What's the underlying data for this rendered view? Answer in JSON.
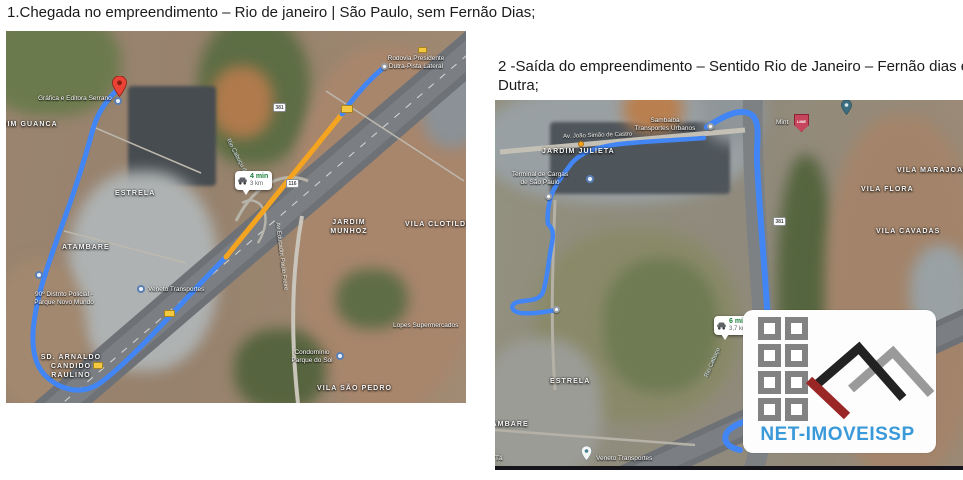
{
  "page": {
    "title1": "1.Chegada no empreendimento – Rio de janeiro | São Paulo, sem Fernão Dias;",
    "title2_line1": "2 -Saída do empreendimento – Sentido Rio de Janeiro – Fernão dias e",
    "title2_line2": "Dutra;"
  },
  "map1": {
    "eta": {
      "time": "4 min",
      "dist": "3 km"
    },
    "shields": {
      "br381": "381",
      "br116": "116"
    },
    "labels": {
      "grafica": "Gráfica e Editora Serrano",
      "guanca": "JARDIM GUANCA",
      "estrela": "ESTRELA",
      "dutra_l1": "Rodovia Presidente",
      "dutra_l2": "Dutra-Pista Lateral",
      "cabucu": "Rio Cabuçu de Cima",
      "atambare": "ATAMBARE",
      "police_l1": "90º Distrito Policial -",
      "police_l2": "Parque Novo Mundo",
      "veneto": "Veneto Transportes",
      "arnaldo_l1": "SD. ARNALDO",
      "arnaldo_l2": "CANDIDO",
      "arnaldo_l3": "RAULINO",
      "munhoz_l1": "JARDIM",
      "munhoz_l2": "MUNHOZ",
      "clotilde": "VILA CLOTILDE",
      "freire": "Av Educador Paulo Freire",
      "lopes": "Lopes Supermercados",
      "condominio_l1": "Condomínio",
      "condominio_l2": "Parque do Sol",
      "saopedro": "VILA SÃO PEDRO"
    }
  },
  "map2": {
    "eta": {
      "time": "6 min",
      "dist": "3,7 km"
    },
    "shields": {
      "br381": "381"
    },
    "labels": {
      "sambaiba_l1": "Sambaiba",
      "sambaiba_l2": "Transportes Urbanos",
      "castro": "Av. João Simão de Castro",
      "julieta": "JARDIM JULIETA",
      "terminal_l1": "Terminal de Cargas",
      "terminal_l2": "de São Paulo",
      "mint": "Mint",
      "mint_marker": "LINE",
      "marajoara": "VILA MARAJOARA",
      "flora": "VILA FLORA",
      "cavadas": "VILA CAVADAS",
      "cabucu": "Rio Cabuçu",
      "estrela": "ESTRELA",
      "atambare": "ATAMBARE",
      "fragment": "Tá",
      "veneto": "Veneto Transportes"
    }
  },
  "logo": {
    "brand": "NET-IMOVEISSP"
  },
  "colors": {
    "route_blue": "#4285f4",
    "traffic_orange": "#f5a41f",
    "eta_green": "#188038",
    "brand_blue": "#3a99d8",
    "logo_red": "#9b2626",
    "logo_black": "#222222",
    "logo_gray": "#999999"
  }
}
